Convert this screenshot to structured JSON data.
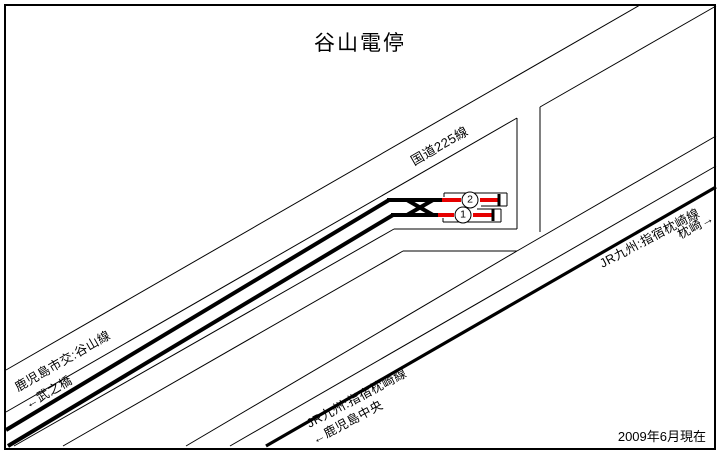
{
  "title": "谷山電停",
  "date_note": "2009年6月現在",
  "colors": {
    "line": "#000000",
    "track_red": "#e60000",
    "background": "#ffffff"
  },
  "labels": {
    "national_road": "国道225線",
    "tram_route": "鹿児島市交:谷山線",
    "tram_dir": "←武之橋",
    "jr_ne": "JR九州:指宿枕崎線",
    "jr_ne_dir": "枕崎→",
    "jr_sw": "JR九州:指宿枕崎線",
    "jr_sw_dir": "←鹿児島中央"
  },
  "platforms": [
    {
      "number": "1"
    },
    {
      "number": "2"
    }
  ],
  "geometry": {
    "styles": {
      "thin": {
        "w": 1,
        "color": "line"
      },
      "bracket": {
        "w": 1,
        "color": "line"
      },
      "thick": {
        "w": 4,
        "color": "line"
      },
      "jr": {
        "w": 3.2,
        "color": "line"
      },
      "red": {
        "w": 4,
        "color": "track_red"
      },
      "buffer": {
        "w": 3,
        "color": "line"
      }
    },
    "segments": [
      {
        "name": "road-upper-edge",
        "s": "thin",
        "x1": 6,
        "y1": 370,
        "x2": 640,
        "y2": 5
      },
      {
        "name": "road-lower-edge-west",
        "s": "thin",
        "x1": 6,
        "y1": 412,
        "x2": 517,
        "y2": 118
      },
      {
        "name": "road-lower-edge-east",
        "s": "thin",
        "x1": 540,
        "y1": 107,
        "x2": 716,
        "y2": 6
      },
      {
        "name": "side-road-west-edge",
        "s": "thin",
        "x1": 517,
        "y1": 118,
        "x2": 517,
        "y2": 229
      },
      {
        "name": "side-road-east-edge",
        "s": "thin",
        "x1": 540,
        "y1": 107,
        "x2": 540,
        "y2": 232
      },
      {
        "name": "stop-area-south-edge-horizontal",
        "s": "thin",
        "x1": 394,
        "y1": 229,
        "x2": 517,
        "y2": 229
      },
      {
        "name": "stop-area-south-edge-diagonal",
        "s": "thin",
        "x1": 394,
        "y1": 229,
        "x2": 14,
        "y2": 446
      },
      {
        "name": "south-road-north-edge-horizontal",
        "s": "thin",
        "x1": 403,
        "y1": 251,
        "x2": 517,
        "y2": 251
      },
      {
        "name": "south-road-north-edge-diagonal",
        "s": "thin",
        "x1": 403,
        "y1": 251,
        "x2": 63,
        "y2": 446
      },
      {
        "name": "south-road-south-edge-sw",
        "s": "thin",
        "x1": 517,
        "y1": 251,
        "x2": 186,
        "y2": 446
      },
      {
        "name": "south-road-south-edge-ne",
        "s": "thin",
        "x1": 517,
        "y1": 251,
        "x2": 716,
        "y2": 136
      },
      {
        "name": "jr-corridor-north-edge",
        "s": "thin",
        "x1": 230,
        "y1": 446,
        "x2": 716,
        "y2": 166
      },
      {
        "name": "jr-line",
        "s": "jr",
        "x1": 266,
        "y1": 446,
        "x2": 716,
        "y2": 187
      },
      {
        "name": "tram-track-north-diagonal",
        "s": "thick",
        "x1": 6,
        "y1": 430,
        "x2": 389,
        "y2": 200
      },
      {
        "name": "tram-track-north-horizontal",
        "s": "thick",
        "x1": 387,
        "y1": 200,
        "x2": 443,
        "y2": 200
      },
      {
        "name": "tram-track-south-diagonal",
        "s": "thick",
        "x1": 8,
        "y1": 446,
        "x2": 393,
        "y2": 215
      },
      {
        "name": "tram-track-south-horizontal",
        "s": "thick",
        "x1": 391,
        "y1": 215,
        "x2": 439,
        "y2": 215
      },
      {
        "name": "crossover-a",
        "s": "thick",
        "x1": 407,
        "y1": 200,
        "x2": 433,
        "y2": 215
      },
      {
        "name": "crossover-b",
        "s": "thick",
        "x1": 407,
        "y1": 215,
        "x2": 433,
        "y2": 200
      },
      {
        "name": "platform-2-track-red-left",
        "s": "red",
        "x1": 442,
        "y1": 200,
        "x2": 461,
        "y2": 200
      },
      {
        "name": "platform-2-track-red-right",
        "s": "red",
        "x1": 480,
        "y1": 200,
        "x2": 498,
        "y2": 200
      },
      {
        "name": "platform-1-track-red-left",
        "s": "red",
        "x1": 438,
        "y1": 215,
        "x2": 454,
        "y2": 215
      },
      {
        "name": "platform-1-track-red-right",
        "s": "red",
        "x1": 473,
        "y1": 215,
        "x2": 492,
        "y2": 215
      },
      {
        "name": "platform-2-buffer-stop",
        "s": "buffer",
        "x1": 499,
        "y1": 194,
        "x2": 499,
        "y2": 206
      },
      {
        "name": "platform-1-buffer-stop",
        "s": "buffer",
        "x1": 493,
        "y1": 209,
        "x2": 493,
        "y2": 221
      },
      {
        "name": "platform-2-edge-top",
        "s": "bracket",
        "x1": 444,
        "y1": 193,
        "x2": 507,
        "y2": 193
      },
      {
        "name": "platform-2-edge-left-tick",
        "s": "bracket",
        "x1": 444,
        "y1": 193,
        "x2": 444,
        "y2": 197
      },
      {
        "name": "platform-2-edge-right",
        "s": "bracket",
        "x1": 507,
        "y1": 193,
        "x2": 507,
        "y2": 206
      },
      {
        "name": "platform-2-edge-bottom-right",
        "s": "bracket",
        "x1": 481,
        "y1": 206,
        "x2": 507,
        "y2": 206
      },
      {
        "name": "platform-1-edge-bottom",
        "s": "bracket",
        "x1": 443,
        "y1": 222,
        "x2": 501,
        "y2": 222
      },
      {
        "name": "platform-1-edge-left-tick",
        "s": "bracket",
        "x1": 443,
        "y1": 218,
        "x2": 443,
        "y2": 222
      },
      {
        "name": "platform-1-edge-right",
        "s": "bracket",
        "x1": 501,
        "y1": 209,
        "x2": 501,
        "y2": 222
      },
      {
        "name": "platform-1-edge-top-right",
        "s": "bracket",
        "x1": 477,
        "y1": 209,
        "x2": 501,
        "y2": 209
      }
    ]
  }
}
